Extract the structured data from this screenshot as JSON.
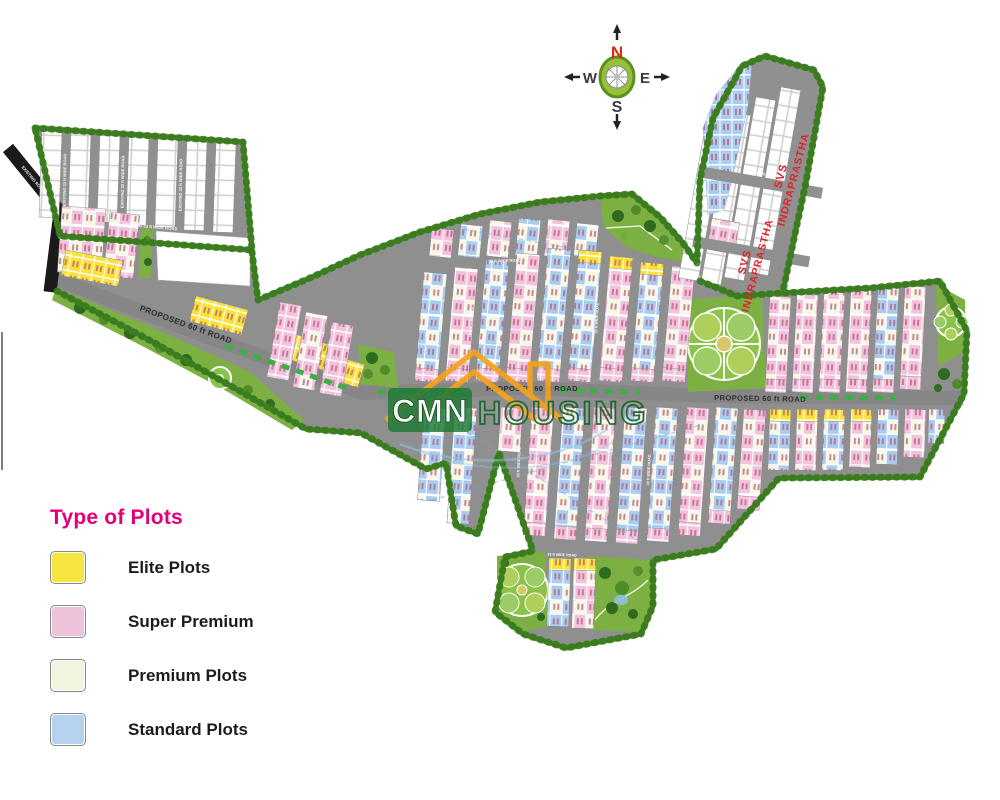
{
  "compass": {
    "n": "N",
    "e": "E",
    "s": "S",
    "w": "W"
  },
  "legend": {
    "title": "Type of Plots",
    "items": [
      {
        "label": "Elite Plots",
        "color": "#f7e642"
      },
      {
        "label": "Super Premium",
        "color": "#efc2dc"
      },
      {
        "label": "Premium Plots",
        "color": "#f2f4e0"
      },
      {
        "label": "Standard Plots",
        "color": "#b5d3ef"
      }
    ]
  },
  "watermark": {
    "left": "CMN",
    "right": "HOUSING"
  },
  "labels": {
    "project_line1": "SVS",
    "project_line2": "INDRAPRASTHA",
    "road_60": "PROPOSED 60 ft ROAD",
    "road_33": "33 ft WIDE ROAD",
    "road_existing": "EXISTING 33 ft WIDE ROAD",
    "road_black": "EXISTING ROAD"
  },
  "colors": {
    "elite": "#f7e642",
    "super_premium": "#efc2dc",
    "premium": "#f2f4e0",
    "standard": "#b5d3ef",
    "road": "#8f8f8f",
    "hedge": "#5a9e2f",
    "park": "#7cb043",
    "project_text": "#e32227",
    "legend_title": "#e2007a",
    "watermark_orange": "#f6a21c",
    "watermark_green": "#1e7a34"
  }
}
